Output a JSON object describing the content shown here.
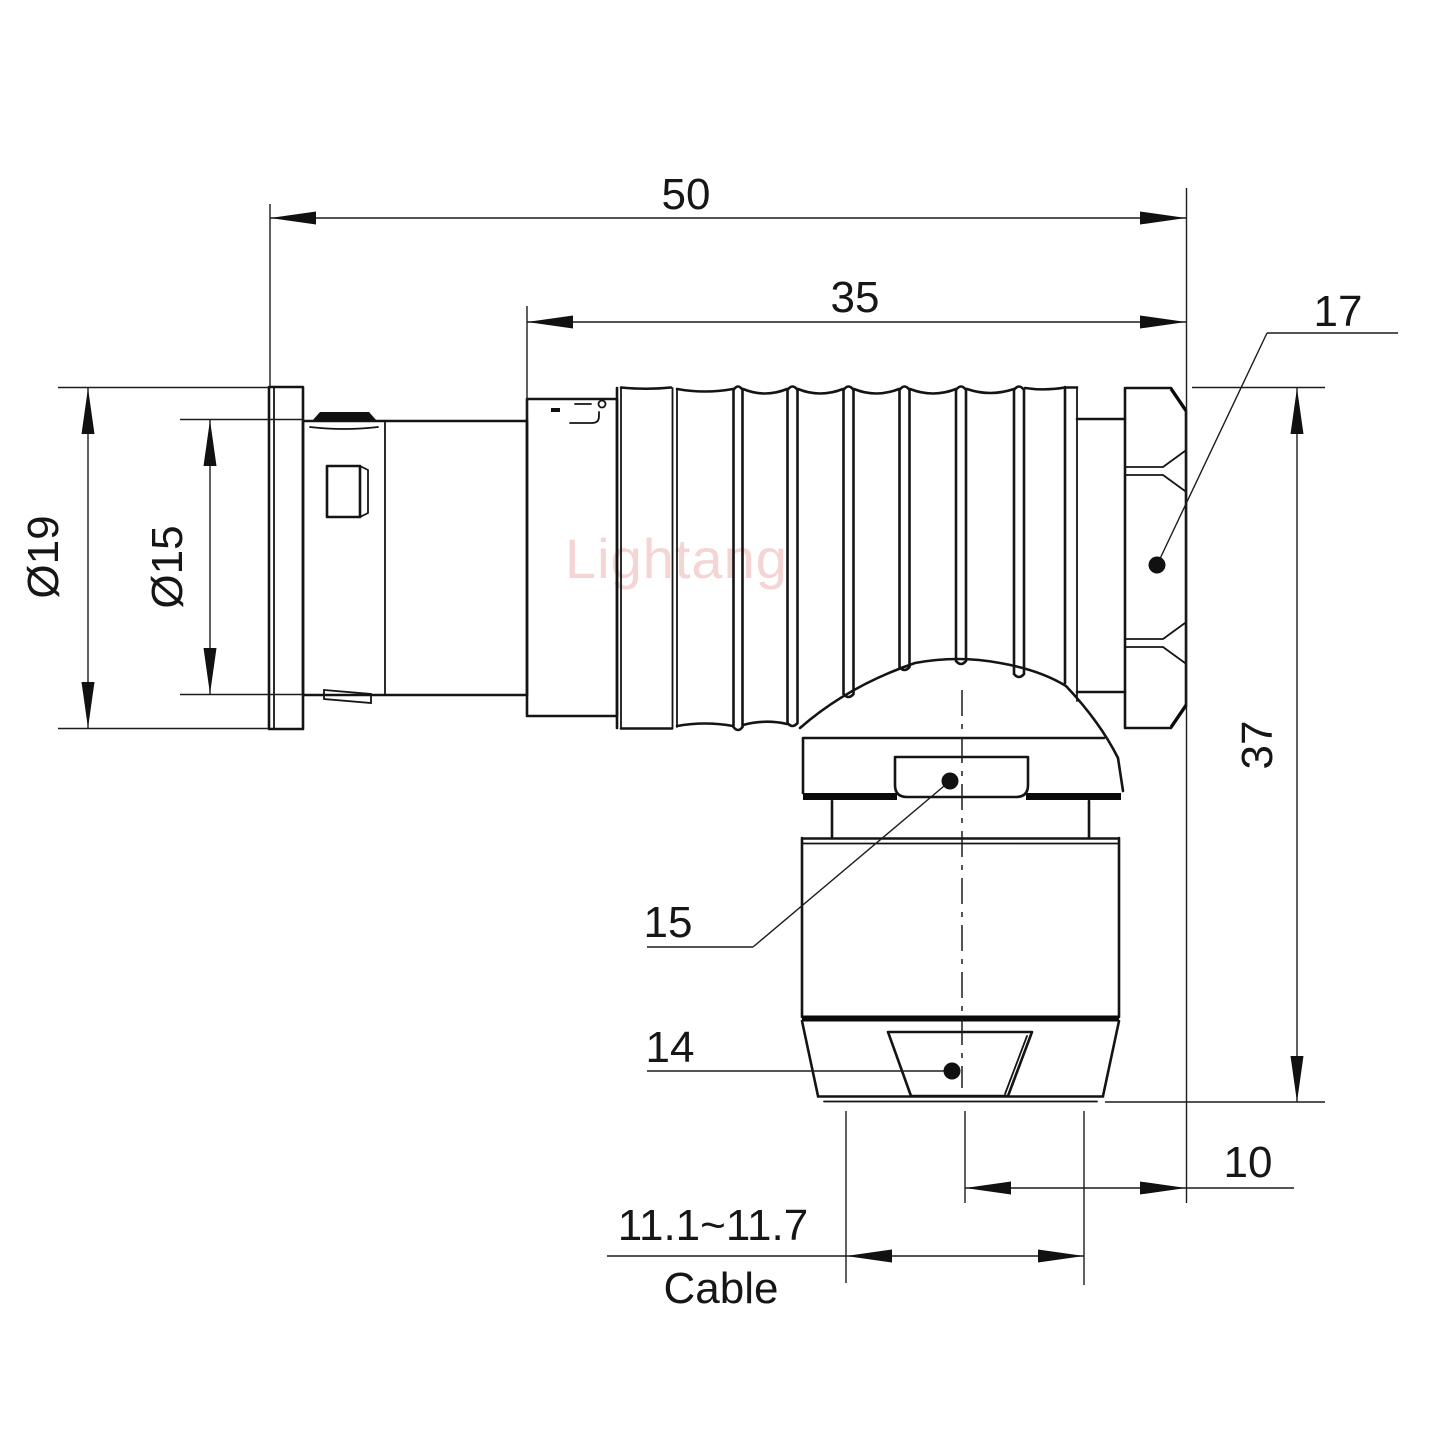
{
  "watermark": "Lightang",
  "dims": {
    "overall_length": "50",
    "body_length": "35",
    "nut_across_flats": "17",
    "dia_outer": "Ø19",
    "dia_inner": "Ø15",
    "height": "37",
    "gland_flat": "15",
    "collet_flat": "14",
    "axis_to_face": "10",
    "cable_range": "11.1~11.7",
    "cable_label": "Cable"
  }
}
